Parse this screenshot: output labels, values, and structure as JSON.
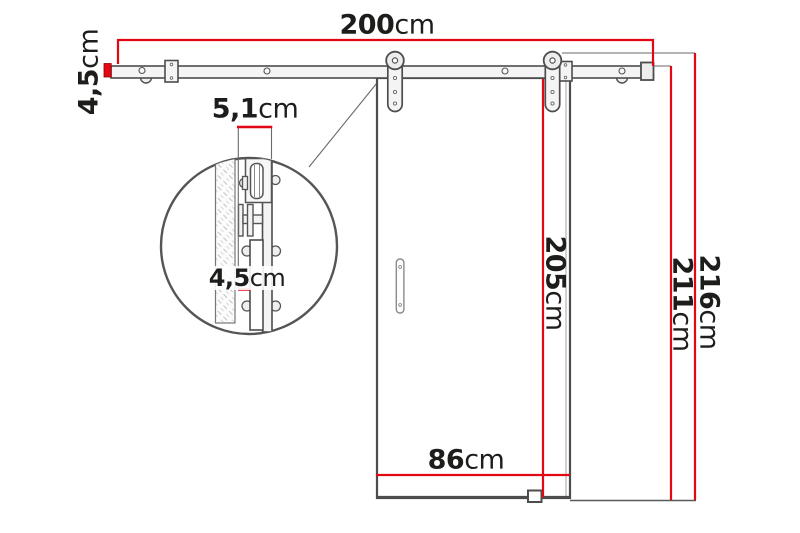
{
  "colors": {
    "dimension_red": "#e30613",
    "line_gray": "#4d4d4d",
    "text_black": "#1d1d1b"
  },
  "dims": {
    "track_length": {
      "value": "200",
      "unit": "cm"
    },
    "track_profile_height": {
      "value": "4,5",
      "unit": "cm"
    },
    "detail_depth": {
      "value": "5,1",
      "unit": "cm"
    },
    "detail_wall_gap": {
      "value": "4,5",
      "unit": "cm"
    },
    "door_height": {
      "value": "205",
      "unit": "cm"
    },
    "track_mount_height": {
      "value": "211",
      "unit": "cm"
    },
    "total_height": {
      "value": "216",
      "unit": "cm"
    },
    "door_width": {
      "value": "86",
      "unit": "cm"
    }
  }
}
